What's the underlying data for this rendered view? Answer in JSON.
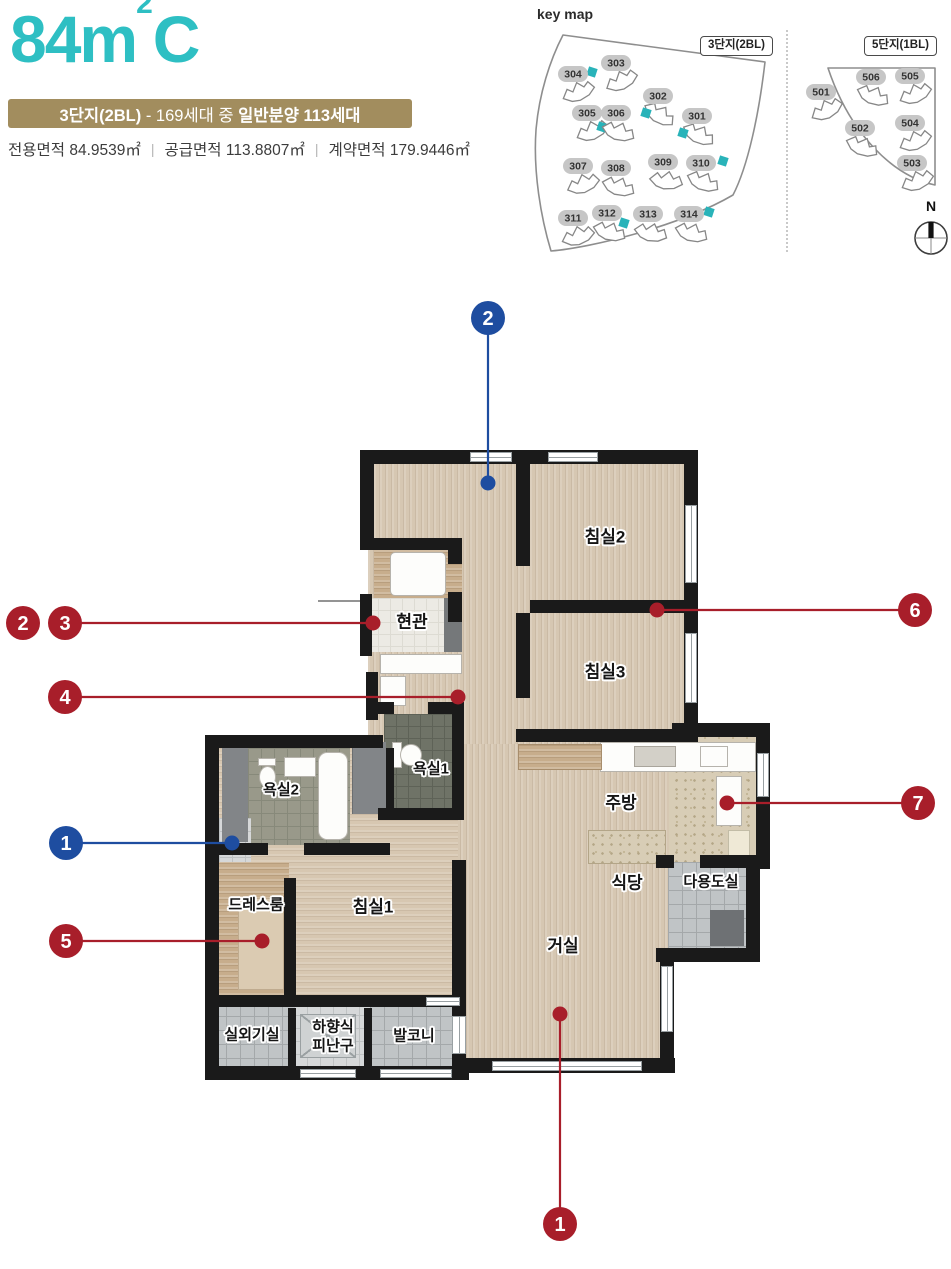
{
  "colors": {
    "teal": "#2ebfc3",
    "banner": "#a28d5e",
    "marker_red": "#a81e2a",
    "marker_blue": "#1e4da0",
    "highlight": "#29b3b9"
  },
  "header": {
    "title_num": "84m",
    "title_sup": "2",
    "title_suffix": "C",
    "banner": {
      "part1": "3단지(2BL)",
      "part2": " - 169세대 중 ",
      "part3": "일반분양 113세대"
    },
    "areas": [
      {
        "label": "전용면적",
        "value": "84.9539㎡"
      },
      {
        "label": "공급면적",
        "value": "113.8807㎡"
      },
      {
        "label": "계약면적",
        "value": "179.9446㎡"
      }
    ]
  },
  "keymap": {
    "title": "key map",
    "compass_label": "N",
    "left": {
      "badge": "3단지(2BL)",
      "buildings": [
        {
          "label": "303",
          "x": 88,
          "y": 41,
          "rot": -18,
          "hl": {
            "x": -24,
            "y": 9
          }
        },
        {
          "label": "304",
          "x": 45,
          "y": 52,
          "rot": -15
        },
        {
          "label": "302",
          "x": 130,
          "y": 74,
          "rot": 40,
          "hl": {
            "x": -12,
            "y": 17
          }
        },
        {
          "label": "305",
          "x": 59,
          "y": 91,
          "rot": -15,
          "hl": {
            "x": 15,
            "y": 14
          }
        },
        {
          "label": "306",
          "x": 88,
          "y": 91,
          "rot": 25
        },
        {
          "label": "301",
          "x": 169,
          "y": 94,
          "rot": 35,
          "hl": {
            "x": -14,
            "y": 17
          }
        },
        {
          "label": "307",
          "x": 50,
          "y": 144,
          "rot": -12
        },
        {
          "label": "308",
          "x": 88,
          "y": 146,
          "rot": 25
        },
        {
          "label": "309",
          "x": 135,
          "y": 140,
          "rot": 15
        },
        {
          "label": "310",
          "x": 173,
          "y": 141,
          "rot": 30,
          "hl": {
            "x": 22,
            "y": -2
          }
        },
        {
          "label": "311",
          "x": 45,
          "y": 196,
          "rot": -10
        },
        {
          "label": "312",
          "x": 79,
          "y": 191,
          "rot": 25,
          "hl": {
            "x": 17,
            "y": 10
          }
        },
        {
          "label": "313",
          "x": 120,
          "y": 192,
          "rot": 20
        },
        {
          "label": "314",
          "x": 161,
          "y": 192,
          "rot": 25,
          "hl": {
            "x": 20,
            "y": -2
          }
        }
      ]
    },
    "right": {
      "badge": "5단지(1BL)",
      "buildings": [
        {
          "label": "501",
          "x": 23,
          "y": 70,
          "rot": -20
        },
        {
          "label": "506",
          "x": 73,
          "y": 55,
          "rot": 30
        },
        {
          "label": "505",
          "x": 112,
          "y": 54,
          "rot": -15
        },
        {
          "label": "502",
          "x": 62,
          "y": 106,
          "rot": 30
        },
        {
          "label": "504",
          "x": 112,
          "y": 101,
          "rot": -15
        },
        {
          "label": "503",
          "x": 114,
          "y": 141,
          "rot": -15
        }
      ]
    }
  },
  "plan": {
    "rooms": [
      {
        "id": "bedroom2",
        "label": "침실2",
        "x": 605,
        "y": 537
      },
      {
        "id": "bedroom3",
        "label": "침실3",
        "x": 605,
        "y": 672
      },
      {
        "id": "entrance",
        "label": "현관",
        "x": 412,
        "y": 622
      },
      {
        "id": "bath1",
        "label": "욕실1",
        "x": 431,
        "y": 770,
        "s": true
      },
      {
        "id": "bath2",
        "label": "욕실2",
        "x": 281,
        "y": 791,
        "s": true
      },
      {
        "id": "dressroom",
        "label": "드레스룸",
        "x": 256,
        "y": 906,
        "s": true
      },
      {
        "id": "bedroom1",
        "label": "침실1",
        "x": 373,
        "y": 907
      },
      {
        "id": "kitchen",
        "label": "주방",
        "x": 621,
        "y": 803
      },
      {
        "id": "dining",
        "label": "식당",
        "x": 627,
        "y": 883
      },
      {
        "id": "utility",
        "label": "다용도실",
        "x": 711,
        "y": 883,
        "s": true
      },
      {
        "id": "living",
        "label": "거실",
        "x": 563,
        "y": 946
      },
      {
        "id": "ac-room",
        "label": "실외기실",
        "x": 252,
        "y": 1036,
        "s": true
      },
      {
        "id": "escape-hatch",
        "label": "하향식\n피난구",
        "x": 333,
        "y": 1037,
        "s": true
      },
      {
        "id": "balcony",
        "label": "발코니",
        "x": 414,
        "y": 1037,
        "s": true
      }
    ],
    "markers": [
      {
        "n": "2",
        "color": "blue",
        "cx": 488,
        "cy": 318,
        "dx": 488,
        "dy": 483
      },
      {
        "n": "2",
        "color": "red",
        "cx": 23,
        "cy": 623
      },
      {
        "n": "3",
        "color": "red",
        "cx": 65,
        "cy": 623,
        "dx": 373,
        "dy": 623
      },
      {
        "n": "4",
        "color": "red",
        "cx": 65,
        "cy": 697,
        "dx": 458,
        "dy": 697
      },
      {
        "n": "1",
        "color": "blue",
        "cx": 66,
        "cy": 843,
        "dx": 232,
        "dy": 843
      },
      {
        "n": "5",
        "color": "red",
        "cx": 66,
        "cy": 941,
        "dx": 262,
        "dy": 941
      },
      {
        "n": "6",
        "color": "red",
        "cx": 915,
        "cy": 610,
        "dx": 657,
        "dy": 610
      },
      {
        "n": "7",
        "color": "red",
        "cx": 918,
        "cy": 803,
        "dx": 727,
        "dy": 803
      },
      {
        "n": "1",
        "color": "red",
        "cx": 560,
        "cy": 1224,
        "dx": 560,
        "dy": 1014
      }
    ]
  }
}
